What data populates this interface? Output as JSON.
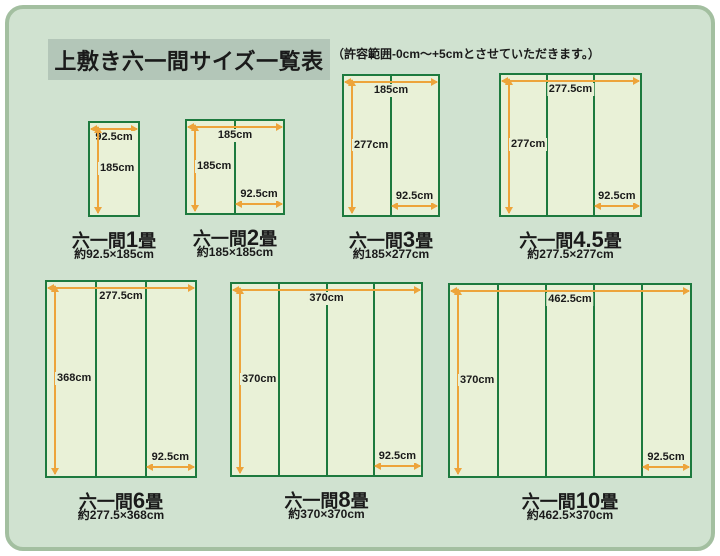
{
  "title": "上敷き六一間サイズ一覧表",
  "note": "（許容範囲-0cm～+5cmとさせていただきます。）",
  "unit": "cm",
  "colors": {
    "page_bg": "#ffffff",
    "panel_fill": "#d0e2d0",
    "panel_border": "#a3bfa0",
    "title_box_bg": "#b3c6b8",
    "mat_fill": "#e9f1d7",
    "mat_border": "#1d7a3e",
    "arrow": "#eda43b",
    "text": "#1a1a1a"
  },
  "diagrams": [
    {
      "id": "1jo",
      "caption_prefix": "六一間",
      "caption_num": "1",
      "caption_suffix": "畳",
      "size_text": "約92.5×185cm",
      "width_cm": 92.5,
      "height_cm": 185,
      "columns": 1,
      "top_label": "92.5cm",
      "left_label": "185cm",
      "bottom_label": null,
      "layout": {
        "x": 88,
        "y": 121,
        "w": 52,
        "h": 96
      }
    },
    {
      "id": "2jo",
      "caption_prefix": "六一間",
      "caption_num": "2",
      "caption_suffix": "畳",
      "size_text": "約185×185cm",
      "width_cm": 185,
      "height_cm": 185,
      "columns": 2,
      "top_label": "185cm",
      "left_label": "185cm",
      "bottom_label": "92.5cm",
      "layout": {
        "x": 185,
        "y": 119,
        "w": 100,
        "h": 96
      }
    },
    {
      "id": "3jo",
      "caption_prefix": "六一間",
      "caption_num": "3",
      "caption_suffix": "畳",
      "size_text": "約185×277cm",
      "width_cm": 185,
      "height_cm": 277,
      "columns": 2,
      "top_label": "185cm",
      "left_label": "277cm",
      "bottom_label": "92.5cm",
      "layout": {
        "x": 342,
        "y": 74,
        "w": 98,
        "h": 143
      }
    },
    {
      "id": "4-5jo",
      "caption_prefix": "六一間",
      "caption_num": "4.5",
      "caption_suffix": "畳",
      "size_text": "約277.5×277cm",
      "width_cm": 277.5,
      "height_cm": 277,
      "columns": 3,
      "top_label": "277.5cm",
      "left_label": "277cm",
      "bottom_label": "92.5cm",
      "layout": {
        "x": 499,
        "y": 73,
        "w": 143,
        "h": 144
      }
    },
    {
      "id": "6jo",
      "caption_prefix": "六一間",
      "caption_num": "6",
      "caption_suffix": "畳",
      "size_text": "約277.5×368cm",
      "width_cm": 277.5,
      "height_cm": 368,
      "columns": 3,
      "top_label": "277.5cm",
      "left_label": "368cm",
      "bottom_label": "92.5cm",
      "layout": {
        "x": 45,
        "y": 280,
        "w": 152,
        "h": 198
      }
    },
    {
      "id": "8jo",
      "caption_prefix": "六一間",
      "caption_num": "8",
      "caption_suffix": "畳",
      "size_text": "約370×370cm",
      "width_cm": 370,
      "height_cm": 370,
      "columns": 4,
      "top_label": "370cm",
      "left_label": "370cm",
      "bottom_label": "92.5cm",
      "layout": {
        "x": 230,
        "y": 282,
        "w": 193,
        "h": 195
      }
    },
    {
      "id": "10jo",
      "caption_prefix": "六一間",
      "caption_num": "10",
      "caption_suffix": "畳",
      "size_text": "約462.5×370cm",
      "width_cm": 462.5,
      "height_cm": 370,
      "columns": 5,
      "top_label": "462.5cm",
      "left_label": "370cm",
      "bottom_label": "92.5cm",
      "layout": {
        "x": 448,
        "y": 283,
        "w": 244,
        "h": 195
      }
    }
  ]
}
